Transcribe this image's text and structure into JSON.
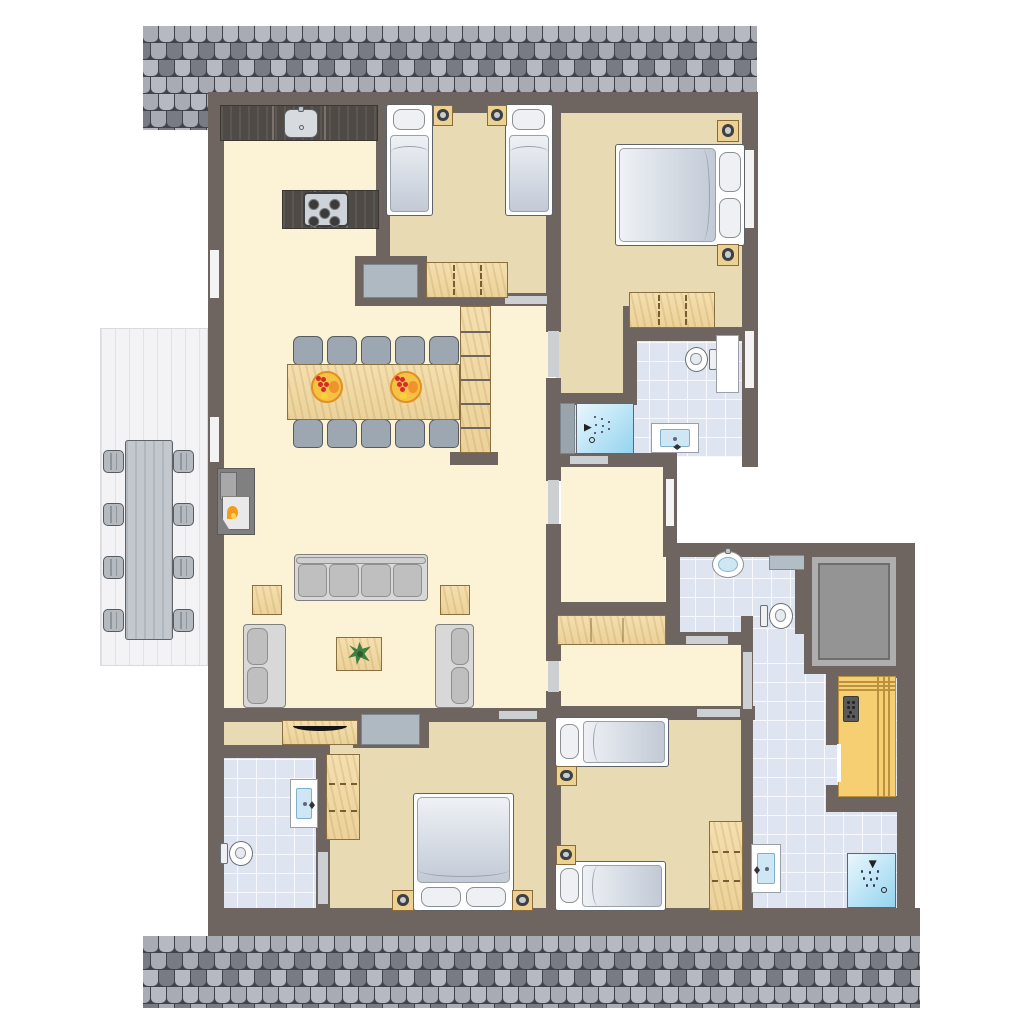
{
  "meta": {
    "title": "apartment-floor-plan",
    "type": "architectural top-down floor plan, no text labels",
    "rooms": [
      "kitchen-open-living-dining",
      "twin-bedroom-top",
      "master-bedroom-top-right",
      "bathroom-top-right",
      "wc-middle-right",
      "elevator-shaft",
      "sauna-bathroom-bottom-right",
      "twin-bedroom-bottom-center",
      "double-bedroom-bottom-left",
      "bathroom-bottom-left",
      "terrace-left",
      "hallway-center",
      "staircase"
    ]
  },
  "palette": {
    "wall": "#6e6560",
    "cream": "#fcf3d7",
    "tan": "#e8dbb3",
    "tile": "#dfe5f0",
    "tileLine": "#f7f9fd",
    "terrace": "#f3f3f6",
    "terraceLine": "#e1e1e6",
    "wood": "#f1d9a3",
    "woodEdge": "#8a6f40",
    "woodDark": "#4f4a45",
    "counterSeam": "#7b736a",
    "sauna": "#f6cf72",
    "saunaLine": "#bb913f",
    "grayFurn": "#aeb9c1",
    "grayFurnEdge": "#7c858c",
    "door": "#cdd0d3",
    "window": "#f3f3f3",
    "roofBg": "#41434c",
    "roofTiles": [
      "#a9abb3",
      "#8f9199",
      "#797b83",
      "#63656d",
      "#b7b9c1",
      "#545660"
    ],
    "mattA": "#eef1f5",
    "mattB": "#c2cad6",
    "pillow": "#eef0f3",
    "bedEdge": "#5d6368",
    "sofa": "#d8d8d8",
    "sofaEdge": "#7f7f7f",
    "cushion": "#bfbfbf",
    "cushionEdge": "#8f8f8f",
    "chair": "#9da7b1",
    "chairEdge": "#555b61",
    "outTable": "#c2c8ce",
    "showerA": "#eaf7fd",
    "showerB": "#93d4ef",
    "basin": "#cfe7f5",
    "basinEdge": "#7fb0cc",
    "fixtureEdge": "#6a7076",
    "elevCore": "#949494",
    "elevBand": "#aeaeae",
    "flame": "#f59a1f",
    "flameCore": "#ffd84d",
    "plant": "#3f8040",
    "fruitBowl": "#f7c244",
    "fruitEdge": "#e0901f",
    "grape": "#d42b2b",
    "orange": "#f0922d",
    "tv": "#141414",
    "lampDark": "#3d4144",
    "lampLight": "#c8ccd0"
  },
  "scene": {
    "width": 1024,
    "height": 1024,
    "background": "#ffffff"
  },
  "roofs": [
    {
      "name": "roof-top",
      "rect": [
        143,
        26,
        614,
        68
      ]
    },
    {
      "name": "roof-top-left-ext",
      "rect": [
        143,
        94,
        65,
        36
      ]
    },
    {
      "name": "roof-bottom",
      "rect": [
        143,
        936,
        777,
        72
      ]
    }
  ],
  "floors": [
    {
      "type": "cream",
      "name": "kitchen-living-floor",
      "rect": [
        222,
        105,
        156,
        610
      ]
    },
    {
      "type": "cream",
      "name": "dining-hall-floor",
      "rect": [
        376,
        298,
        172,
        417
      ]
    },
    {
      "type": "cream",
      "name": "vestibule-floor",
      "rect": [
        561,
        460,
        104,
        150
      ]
    },
    {
      "type": "cream",
      "name": "hallway-floor",
      "rect": [
        556,
        610,
        190,
        103
      ]
    },
    {
      "type": "tan",
      "name": "twin-bedroom-floor",
      "rect": [
        386,
        105,
        162,
        195
      ]
    },
    {
      "type": "tan",
      "name": "master-bedroom-floor",
      "rect": [
        556,
        105,
        190,
        230
      ]
    },
    {
      "type": "tan",
      "name": "master-bedroom-arm-floor",
      "rect": [
        556,
        300,
        72,
        100
      ]
    },
    {
      "type": "tan",
      "name": "bedroom3-floor",
      "rect": [
        553,
        712,
        192,
        200
      ]
    },
    {
      "type": "tan",
      "name": "bedroom4-floor",
      "rect": [
        325,
        714,
        223,
        198
      ]
    },
    {
      "type": "tan",
      "name": "bedroom4-arm-floor",
      "rect": [
        218,
        714,
        110,
        36
      ]
    },
    {
      "type": "tile",
      "name": "bathroom1-floor",
      "rect": [
        630,
        335,
        115,
        122
      ]
    },
    {
      "type": "tile",
      "name": "bathroom1-shower-floor",
      "rect": [
        572,
        400,
        60,
        56
      ]
    },
    {
      "type": "tile",
      "name": "bathroom2-floor",
      "rect": [
        218,
        752,
        102,
        160
      ]
    },
    {
      "type": "tile",
      "name": "wc-floor",
      "rect": [
        676,
        552,
        122,
        84
      ]
    },
    {
      "type": "tile",
      "name": "bathroom3-passage-floor",
      "rect": [
        748,
        628,
        62,
        20
      ]
    },
    {
      "type": "tile",
      "name": "bathroom3-floor",
      "rect": [
        748,
        645,
        149,
        266
      ]
    },
    {
      "type": "terrace",
      "name": "terrace-deck",
      "rect": [
        100,
        328,
        108,
        338
      ]
    }
  ],
  "walls": [
    [
      208,
      92,
      549,
      21
    ],
    [
      208,
      92,
      16,
      844
    ],
    [
      208,
      908,
      712,
      28
    ],
    [
      742,
      92,
      16,
      375
    ],
    [
      376,
      92,
      14,
      174
    ],
    [
      355,
      256,
      72,
      50
    ],
    [
      386,
      293,
      167,
      13
    ],
    [
      546,
      92,
      15,
      240
    ],
    [
      546,
      378,
      15,
      103
    ],
    [
      546,
      524,
      15,
      137
    ],
    [
      546,
      691,
      15,
      217
    ],
    [
      450,
      293,
      48,
      13
    ],
    [
      450,
      452,
      48,
      13
    ],
    [
      623,
      306,
      14,
      99
    ],
    [
      631,
      327,
      112,
      14
    ],
    [
      561,
      393,
      74,
      12
    ],
    [
      561,
      453,
      116,
      14
    ],
    [
      663,
      467,
      14,
      90
    ],
    [
      663,
      543,
      252,
      14
    ],
    [
      897,
      543,
      18,
      365
    ],
    [
      666,
      557,
      14,
      88
    ],
    [
      666,
      632,
      86,
      13
    ],
    [
      795,
      555,
      13,
      79
    ],
    [
      546,
      602,
      122,
      15
    ],
    [
      741,
      616,
      12,
      100
    ],
    [
      741,
      712,
      12,
      196
    ],
    [
      546,
      706,
      209,
      14
    ],
    [
      208,
      708,
      217,
      14
    ],
    [
      353,
      708,
      76,
      40
    ],
    [
      420,
      708,
      126,
      14
    ],
    [
      208,
      745,
      112,
      13
    ],
    [
      316,
      745,
      14,
      163
    ],
    [
      826,
      660,
      71,
      18
    ],
    [
      826,
      796,
      71,
      16
    ],
    [
      826,
      678,
      12,
      67
    ],
    [
      826,
      785,
      12,
      11
    ]
  ],
  "openings": [
    {
      "kind": "door",
      "rect": [
        505,
        296,
        42,
        8
      ]
    },
    {
      "kind": "door",
      "rect": [
        548,
        331,
        11,
        46
      ]
    },
    {
      "kind": "door",
      "rect": [
        548,
        480,
        11,
        44
      ]
    },
    {
      "kind": "door",
      "rect": [
        548,
        661,
        11,
        31
      ]
    },
    {
      "kind": "door",
      "rect": [
        570,
        456,
        38,
        8
      ]
    },
    {
      "kind": "door",
      "rect": [
        686,
        636,
        42,
        8
      ]
    },
    {
      "kind": "door",
      "rect": [
        743,
        652,
        9,
        57
      ]
    },
    {
      "kind": "door",
      "rect": [
        697,
        709,
        43,
        8
      ]
    },
    {
      "kind": "door",
      "rect": [
        499,
        711,
        38,
        8
      ]
    },
    {
      "kind": "door",
      "rect": [
        318,
        852,
        10,
        52
      ]
    },
    {
      "kind": "window",
      "rect": [
        210,
        250,
        9,
        48
      ]
    },
    {
      "kind": "window",
      "rect": [
        210,
        417,
        9,
        45
      ]
    },
    {
      "kind": "window",
      "rect": [
        745,
        150,
        9,
        78
      ]
    },
    {
      "kind": "window",
      "rect": [
        745,
        331,
        9,
        57
      ]
    },
    {
      "kind": "window",
      "rect": [
        666,
        479,
        8,
        47
      ]
    }
  ],
  "furniture": [
    {
      "type": "counter",
      "name": "kitchen-counter",
      "rect": [
        220,
        105,
        158,
        36
      ]
    },
    {
      "type": "sinkk",
      "name": "kitchen-sink",
      "rect": [
        284,
        109,
        34,
        29
      ]
    },
    {
      "type": "counter",
      "name": "kitchen-island",
      "rect": [
        282,
        190,
        97,
        39
      ]
    },
    {
      "type": "stove",
      "name": "stove-cooktop",
      "rect": [
        303,
        192,
        46,
        35
      ]
    },
    {
      "type": "chair",
      "name": "dining-chair",
      "rect": [
        293,
        336,
        30,
        29
      ]
    },
    {
      "type": "chair",
      "name": "dining-chair",
      "rect": [
        327,
        336,
        30,
        29
      ]
    },
    {
      "type": "chair",
      "name": "dining-chair",
      "rect": [
        361,
        336,
        30,
        29
      ]
    },
    {
      "type": "chair",
      "name": "dining-chair",
      "rect": [
        395,
        336,
        30,
        29
      ]
    },
    {
      "type": "chair",
      "name": "dining-chair",
      "rect": [
        429,
        336,
        30,
        29
      ]
    },
    {
      "type": "chair",
      "name": "dining-chair",
      "rect": [
        293,
        419,
        30,
        29
      ]
    },
    {
      "type": "chair",
      "name": "dining-chair",
      "rect": [
        327,
        419,
        30,
        29
      ]
    },
    {
      "type": "chair",
      "name": "dining-chair",
      "rect": [
        361,
        419,
        30,
        29
      ]
    },
    {
      "type": "chair",
      "name": "dining-chair",
      "rect": [
        395,
        419,
        30,
        29
      ]
    },
    {
      "type": "chair",
      "name": "dining-chair",
      "rect": [
        429,
        419,
        30,
        29
      ]
    },
    {
      "type": "tablew",
      "name": "dining-table",
      "rect": [
        287,
        364,
        173,
        56
      ]
    },
    {
      "type": "bowl",
      "name": "fruit-bowl",
      "rect": [
        311,
        371,
        32,
        32
      ]
    },
    {
      "type": "bowl",
      "name": "fruit-bowl",
      "rect": [
        390,
        371,
        32,
        32
      ]
    },
    {
      "type": "stairs",
      "name": "staircase",
      "rect": [
        460,
        306,
        31,
        147
      ]
    },
    {
      "type": "fireplace",
      "name": "fireplace",
      "rect": [
        217,
        468,
        38,
        67
      ]
    },
    {
      "type": "sofa",
      "name": "sofa-four-seat",
      "rect": [
        294,
        554,
        134,
        47
      ]
    },
    {
      "type": "sidetable",
      "name": "side-table",
      "rect": [
        252,
        585,
        30,
        30
      ]
    },
    {
      "type": "sidetable",
      "name": "side-table",
      "rect": [
        440,
        585,
        30,
        30
      ]
    },
    {
      "type": "loveseat",
      "name": "loveseat-left",
      "rect": [
        243,
        624,
        43,
        84
      ],
      "side": "left"
    },
    {
      "type": "loveseat",
      "name": "loveseat-right",
      "rect": [
        435,
        624,
        39,
        84
      ],
      "side": "right"
    },
    {
      "type": "coffee",
      "name": "coffee-table-with-plant",
      "rect": [
        336,
        637,
        46,
        34
      ]
    },
    {
      "type": "dresser",
      "name": "niche-dresser",
      "rect": [
        363,
        264,
        55,
        34
      ]
    },
    {
      "type": "dresser",
      "name": "niche-dresser",
      "rect": [
        361,
        714,
        59,
        31
      ]
    },
    {
      "type": "tvboard",
      "name": "tv-sideboard",
      "rect": [
        282,
        720,
        76,
        25
      ]
    },
    {
      "type": "outchair",
      "name": "terrace-chair",
      "rect": [
        103,
        450,
        21,
        23
      ]
    },
    {
      "type": "outchair",
      "name": "terrace-chair",
      "rect": [
        103,
        503,
        21,
        23
      ]
    },
    {
      "type": "outchair",
      "name": "terrace-chair",
      "rect": [
        103,
        556,
        21,
        23
      ]
    },
    {
      "type": "outchair",
      "name": "terrace-chair",
      "rect": [
        103,
        609,
        21,
        23
      ]
    },
    {
      "type": "outchair",
      "name": "terrace-chair",
      "rect": [
        173,
        450,
        21,
        23
      ]
    },
    {
      "type": "outchair",
      "name": "terrace-chair",
      "rect": [
        173,
        503,
        21,
        23
      ]
    },
    {
      "type": "outchair",
      "name": "terrace-chair",
      "rect": [
        173,
        556,
        21,
        23
      ]
    },
    {
      "type": "outchair",
      "name": "terrace-chair",
      "rect": [
        173,
        609,
        21,
        23
      ]
    },
    {
      "type": "outtable",
      "name": "terrace-table",
      "rect": [
        125,
        440,
        48,
        200
      ]
    },
    {
      "type": "bedv",
      "name": "single-bed",
      "rect": [
        386,
        104,
        47,
        112
      ]
    },
    {
      "type": "bedv",
      "name": "single-bed",
      "rect": [
        505,
        104,
        48,
        112
      ]
    },
    {
      "type": "nightstand",
      "name": "nightstand",
      "rect": [
        433,
        105,
        20,
        21
      ]
    },
    {
      "type": "nightstand",
      "name": "nightstand",
      "rect": [
        487,
        105,
        20,
        21
      ]
    },
    {
      "type": "wardrobeh",
      "name": "wardrobe",
      "rect": [
        426,
        262,
        82,
        36
      ]
    },
    {
      "type": "beddh",
      "name": "double-bed",
      "rect": [
        615,
        144,
        130,
        102
      ]
    },
    {
      "type": "nightstand",
      "name": "nightstand",
      "rect": [
        717,
        120,
        22,
        22
      ]
    },
    {
      "type": "nightstand",
      "name": "nightstand",
      "rect": [
        717,
        244,
        22,
        22
      ]
    },
    {
      "type": "wardrobeh",
      "name": "wardrobe",
      "rect": [
        629,
        292,
        86,
        36
      ]
    },
    {
      "type": "showerpanel",
      "name": "shower-wall-panel",
      "rect": [
        560,
        403,
        15,
        51
      ]
    },
    {
      "type": "shower",
      "name": "shower",
      "rect": [
        576,
        403,
        58,
        51
      ],
      "dir": "right"
    },
    {
      "type": "toilet",
      "name": "toilet",
      "rect": [
        684,
        346,
        33,
        27
      ],
      "tank": "right"
    },
    {
      "type": "cabinetw",
      "name": "bathroom-cabinet",
      "rect": [
        716,
        335,
        23,
        58
      ]
    },
    {
      "type": "sinksq",
      "name": "washbasin",
      "rect": [
        651,
        423,
        48,
        30
      ],
      "faucet": "bottom"
    },
    {
      "type": "sinkoval",
      "name": "wc-washbasin",
      "rect": [
        712,
        551,
        32,
        27
      ]
    },
    {
      "type": "shelfg",
      "name": "wc-shelf",
      "rect": [
        769,
        555,
        38,
        15
      ]
    },
    {
      "type": "toilet",
      "name": "wc-toilet",
      "rect": [
        760,
        602,
        34,
        28
      ],
      "tank": "left"
    },
    {
      "type": "cabinetwood",
      "name": "hallway-cabinet",
      "rect": [
        557,
        615,
        109,
        30
      ]
    },
    {
      "type": "elevator",
      "name": "elevator-shaft",
      "rect": [
        804,
        549,
        100,
        125
      ]
    },
    {
      "type": "sauna",
      "name": "sauna",
      "rect": [
        838,
        676,
        58,
        121
      ]
    },
    {
      "type": "shower",
      "name": "shower",
      "rect": [
        847,
        853,
        49,
        55
      ],
      "dir": "down"
    },
    {
      "type": "sinksq",
      "name": "washbasin",
      "rect": [
        751,
        844,
        30,
        49
      ],
      "faucet": "left"
    },
    {
      "type": "bedh",
      "name": "single-bed",
      "rect": [
        555,
        717,
        114,
        50
      ]
    },
    {
      "type": "bedh",
      "name": "single-bed",
      "rect": [
        555,
        861,
        111,
        50
      ]
    },
    {
      "type": "nightstand",
      "name": "nightstand",
      "rect": [
        556,
        766,
        21,
        20
      ]
    },
    {
      "type": "nightstand",
      "name": "nightstand",
      "rect": [
        556,
        845,
        20,
        20
      ]
    },
    {
      "type": "wardrobev",
      "name": "wardrobe",
      "rect": [
        709,
        821,
        34,
        90
      ]
    },
    {
      "type": "wardrobev",
      "name": "wardrobe",
      "rect": [
        326,
        754,
        34,
        86
      ]
    },
    {
      "type": "beddv",
      "name": "double-bed",
      "rect": [
        413,
        793,
        101,
        118
      ]
    },
    {
      "type": "nightstand",
      "name": "nightstand",
      "rect": [
        392,
        890,
        22,
        21
      ]
    },
    {
      "type": "nightstand",
      "name": "nightstand",
      "rect": [
        512,
        890,
        21,
        21
      ]
    },
    {
      "type": "sinksq",
      "name": "washbasin",
      "rect": [
        290,
        779,
        28,
        49
      ],
      "faucet": "right"
    },
    {
      "type": "toilet",
      "name": "toilet",
      "rect": [
        220,
        840,
        34,
        27
      ],
      "tank": "left"
    }
  ]
}
